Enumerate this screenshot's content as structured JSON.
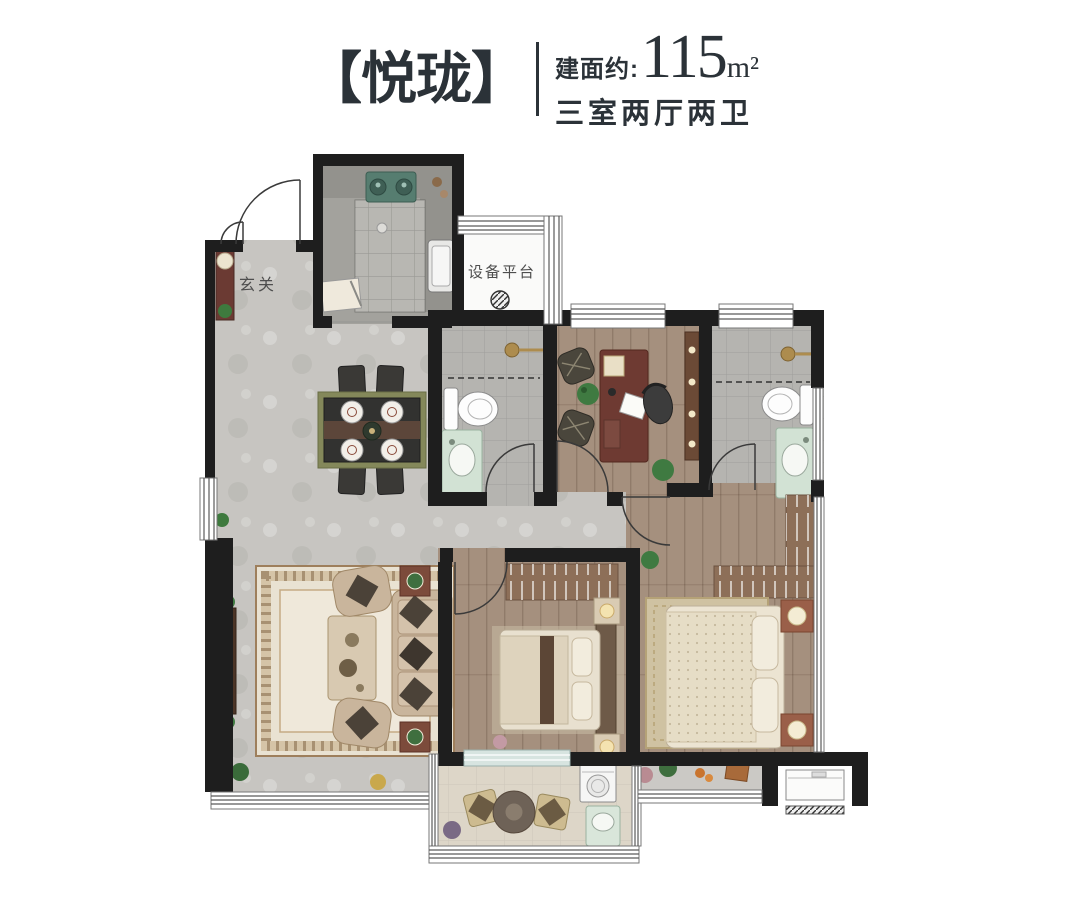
{
  "header": {
    "title": "【悦珑】",
    "area_label": "建面约:",
    "area_value": "115",
    "area_unit": "m²",
    "spec": "三室两厅两卫"
  },
  "plan": {
    "labels": {
      "entry": "玄关",
      "equipment_platform": "设备平台"
    }
  },
  "colors": {
    "title": "#2b3238",
    "wall": "#1e1e1e",
    "label": "#4e4e4e",
    "floor_hall": "#c7c5c1",
    "floor_wood": "#a5907e",
    "floor_tile": "#b5b4b0",
    "floor_balcony": "#ddd6c8"
  },
  "palette_notes": {
    "accent_gold": "#ad8c4e",
    "vanity_green": "#d2e2d4",
    "stove_teal": "#567d70",
    "desk_mahogany": "#6e3a32",
    "rug_cream": "#e9e2d2",
    "wardrobe_wood": "#8d6f58"
  }
}
